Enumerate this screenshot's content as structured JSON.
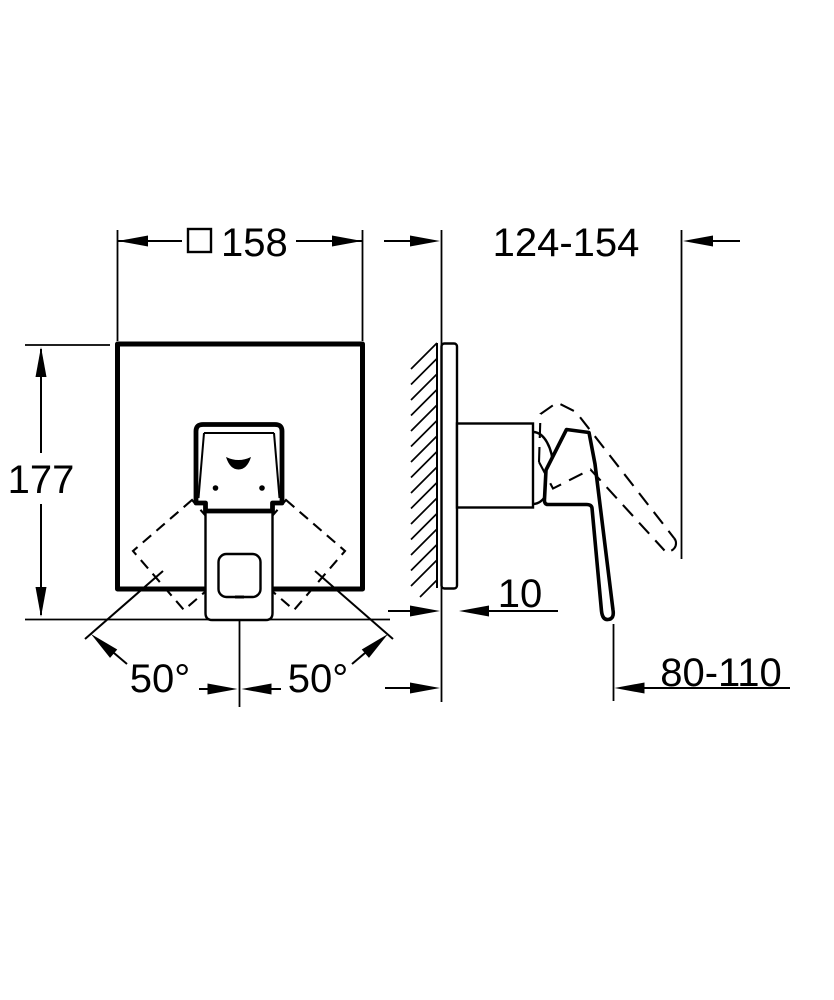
{
  "drawing": {
    "type": "installation-dimension-drawing",
    "colors": {
      "line": "#000000",
      "background": "#ffffff"
    },
    "dimensions": {
      "front_width": {
        "symbol": "□",
        "value": "158"
      },
      "depth_range": {
        "value": "124-154"
      },
      "front_height": {
        "value": "177"
      },
      "plate_thickness": {
        "value": "10"
      },
      "lever_reach": {
        "value": "80-110"
      },
      "angle_left": {
        "value": "50°"
      },
      "angle_right": {
        "value": "50°"
      }
    }
  }
}
